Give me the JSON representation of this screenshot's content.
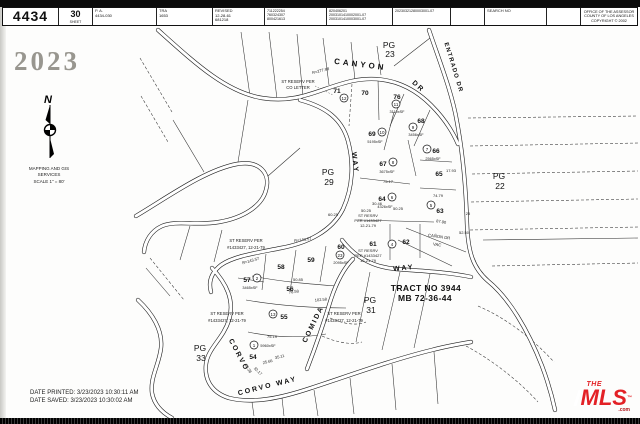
{
  "header": {
    "book": "4434",
    "sheet_value": "30",
    "sheet_label": "SHEET",
    "pa_label": "P. A.",
    "pa_value": "4434-030",
    "tra_label": "TRA",
    "tra_value": "1653",
    "revised_label": "REVISED",
    "revised_lines": [
      "12-28-61",
      "681218"
    ],
    "rev_col_a": [
      "711222254",
      "760324307",
      "800421613"
    ],
    "rev_col_b": [
      "820406201",
      "2003101410002001-07",
      "2003101410003001-07"
    ],
    "rev_col_c": [
      "20230321280003001-07"
    ],
    "search_label": "SEARCH NO",
    "office_lines": [
      "OFFICE OF THE ASSESSOR",
      "COUNTY OF LOS ANGELES",
      "COPYRIGHT © 2002"
    ]
  },
  "side": {
    "year": "2023",
    "org_lines": [
      "MAPPING AND GIS",
      "SERVICES",
      "SCALE 1\" = 80'"
    ]
  },
  "map": {
    "streets": {
      "canyon": "CANYON",
      "canyon_dr": "DR",
      "entrado": "ENTRADO DR",
      "way_upper": "WAY",
      "way_lower": "WAY",
      "corvo": "CORVO",
      "corvo_way": "CORVO WAY",
      "comida": "COMIDA",
      "canon_vac_1": "CAÑON DR",
      "canon_vac_2": "VAC"
    },
    "pages": {
      "pg23": [
        "PG",
        "23"
      ],
      "pg29": [
        "PG",
        "29"
      ],
      "pg22": [
        "PG",
        "22"
      ],
      "pg31": [
        "PG",
        "31"
      ],
      "pg33": [
        "PG",
        "33"
      ]
    },
    "tract": [
      "TRACT NO 3944",
      "MB 72-36-44"
    ],
    "lots": {
      "54": {
        "num": "54",
        "circle": "1",
        "area": "5960xSF"
      },
      "55": {
        "num": "55",
        "circle": "13"
      },
      "56": {
        "num": "56"
      },
      "57": {
        "num": "57",
        "circle": "2",
        "area": "3465xSF"
      },
      "58": {
        "num": "58"
      },
      "59": {
        "num": "59"
      },
      "60": {
        "num": "60",
        "circle": "23",
        "area": "2095xSF"
      },
      "61": {
        "num": "61"
      },
      "62": {
        "num": "62",
        "circle": "4"
      },
      "63": {
        "num": "63",
        "circle": "5"
      },
      "64": {
        "num": "64",
        "circle": "6",
        "area": "4326xSF"
      },
      "65": {
        "num": "65"
      },
      "66": {
        "num": "66",
        "circle": "7",
        "area": "2565xSF"
      },
      "67": {
        "num": "67",
        "circle": "8",
        "area": "3675xSF"
      },
      "68": {
        "num": "68",
        "circle": "9",
        "area": "3456xSF"
      },
      "69": {
        "num": "69",
        "circle": "10",
        "area": "5195xSF"
      },
      "70": {
        "num": "70",
        "circle": "12"
      },
      "71": {
        "num": "71"
      },
      "76": {
        "num": "76",
        "circle": "11",
        "area": "3110xSF"
      }
    },
    "annotations": {
      "co_letter": [
        "ST RESERV PER",
        "CO LETTER"
      ],
      "res_mid": [
        "ST RESERV PER",
        "#1433427, 12-21-79"
      ],
      "res_bottom": [
        "ST RESERV PER",
        "#1433427, 12-21-79"
      ],
      "res_comida": [
        "ST RESERV PER",
        "#1433427, 12-21-79"
      ],
      "res_61a": [
        "ST RESRV",
        "PER #1433427",
        "12-21-79"
      ],
      "res_61b": [
        "ST RESRV",
        "PER #1433427",
        "12-21-79"
      ]
    },
    "dims": [
      "R=277.98",
      "R=143.57",
      "R=143.57",
      "60.25",
      "50.25",
      "50.25",
      "30.46",
      "87.90",
      "52.50",
      "25",
      "75.17",
      "74.79",
      "17.93",
      "102.58",
      "78.58",
      "75.19",
      "25.66",
      "35.11",
      "12.38",
      "32.17",
      "50.85"
    ]
  },
  "footer": {
    "printed": "DATE PRINTED: 3/23/2023 10:30:11 AM",
    "saved": "DATE SAVED: 3/23/2023 10:30:02 AM"
  },
  "logo": {
    "the": "THE",
    "mls": "MLS",
    "tm": "™",
    "com": ".com"
  },
  "colors": {
    "accent_red": "#e32126",
    "year_gray": "#98968f"
  }
}
